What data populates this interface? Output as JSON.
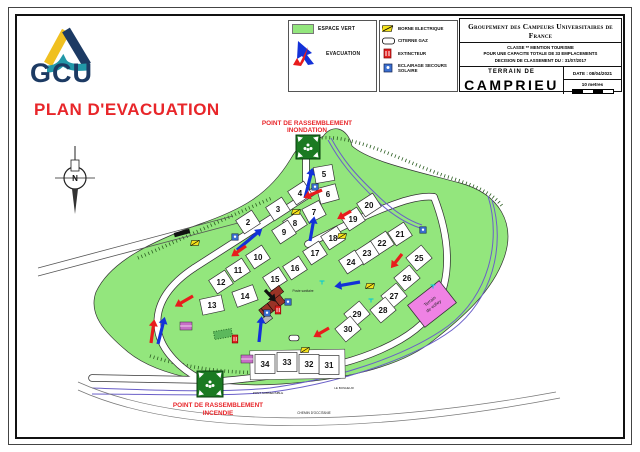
{
  "header": {
    "logo_text": "GCU",
    "legend1": {
      "espace_vert": "ESPACE VERT",
      "evacuation": "EVACUATION"
    },
    "legend2": {
      "borne": "BORNE ELECTRIQUE",
      "citerne": "CITERNE GAZ",
      "extincteur": "EXTINCTEUR",
      "eclairage": "ECLAIRAGE SECOURS SOLAIRE"
    },
    "titleblock": {
      "org": "Groupement des Campeurs Universitaires de France",
      "line1": "CLASSE ** MENTION TOURISME",
      "line2": "POUR UNE CAPACITE TOTALE DE 33 EMPLACEMENTS",
      "line3": "DECISION DE CLASSEMENT DU : 31/07/2017",
      "terrain_de": "TERRAIN DE",
      "site": "CAMPRIEU",
      "date": "DATE : 08/04/2021",
      "scale": "10 metres"
    }
  },
  "title": "PLAN D'EVACUATION",
  "map": {
    "compass_n": "N",
    "colors": {
      "green": "#93e67d",
      "green_edge": "#3a7a2a",
      "red": "#e81c1c",
      "blue": "#1331d8",
      "volley": "#ef82e4",
      "rally_green": "#1b7a22",
      "river": "#6a5fc8"
    },
    "volley": {
      "line1": "Terrain",
      "line2": "de volley",
      "x": 432,
      "y": 304,
      "rot": -38
    },
    "labels": [
      {
        "text": "POINT DE RASSEMBLEMENT",
        "x": 307,
        "y": 125,
        "size": 6.4,
        "color": "#e8262a",
        "bold": true
      },
      {
        "text": "INONDATION",
        "x": 307,
        "y": 132,
        "size": 6.4,
        "color": "#e8262a",
        "bold": true
      },
      {
        "text": "POINT DE RASSEMBLEMENT",
        "x": 218,
        "y": 407,
        "size": 6.4,
        "color": "#e8262a",
        "bold": true
      },
      {
        "text": "INCENDIE",
        "x": 218,
        "y": 415,
        "size": 6.4,
        "color": "#e8262a",
        "bold": true
      },
      {
        "text": "Poste sanitaire",
        "x": 303,
        "y": 292,
        "size": 3.2,
        "color": "#222"
      },
      {
        "text": "PONT SUBMERSIBLE",
        "x": 268,
        "y": 394,
        "size": 3,
        "color": "#222"
      },
      {
        "text": "CHEMIN D'OCCITANIE",
        "x": 314,
        "y": 414,
        "size": 3.2,
        "color": "#222"
      },
      {
        "text": "LE BONHEUR",
        "x": 344,
        "y": 389,
        "size": 3,
        "color": "#222"
      }
    ],
    "plots": [
      {
        "n": "2",
        "x": 248,
        "y": 222,
        "r": -33
      },
      {
        "n": "3",
        "x": 278,
        "y": 209,
        "r": -33
      },
      {
        "n": "4",
        "x": 300,
        "y": 193,
        "r": -33
      },
      {
        "n": "5",
        "x": 324,
        "y": 174,
        "r": -10
      },
      {
        "n": "6",
        "x": 328,
        "y": 194,
        "r": -15
      },
      {
        "n": "7",
        "x": 314,
        "y": 212,
        "r": -28
      },
      {
        "n": "8",
        "x": 295,
        "y": 223,
        "r": -33
      },
      {
        "n": "9",
        "x": 284,
        "y": 232,
        "r": -33
      },
      {
        "n": "10",
        "x": 258,
        "y": 257,
        "r": -33
      },
      {
        "n": "11",
        "x": 238,
        "y": 270,
        "r": -33
      },
      {
        "n": "12",
        "x": 221,
        "y": 282,
        "r": -33
      },
      {
        "n": "13",
        "x": 212,
        "y": 305,
        "r": -12,
        "w": 22
      },
      {
        "n": "14",
        "x": 245,
        "y": 296,
        "r": -20,
        "w": 22
      },
      {
        "n": "15",
        "x": 275,
        "y": 279,
        "r": -33
      },
      {
        "n": "16",
        "x": 295,
        "y": 268,
        "r": -33
      },
      {
        "n": "17",
        "x": 315,
        "y": 253,
        "r": -33
      },
      {
        "n": "18",
        "x": 333,
        "y": 238,
        "r": -33
      },
      {
        "n": "19",
        "x": 353,
        "y": 219,
        "r": -33
      },
      {
        "n": "20",
        "x": 369,
        "y": 205,
        "r": -33
      },
      {
        "n": "21",
        "x": 400,
        "y": 234,
        "r": -33
      },
      {
        "n": "22",
        "x": 382,
        "y": 243,
        "r": -33
      },
      {
        "n": "23",
        "x": 367,
        "y": 253,
        "r": -33
      },
      {
        "n": "24",
        "x": 351,
        "y": 262,
        "r": -33
      },
      {
        "n": "25",
        "x": 419,
        "y": 258,
        "r": -40,
        "w": 20,
        "h": 17
      },
      {
        "n": "26",
        "x": 407,
        "y": 278,
        "r": -40,
        "w": 20,
        "h": 17
      },
      {
        "n": "27",
        "x": 394,
        "y": 296,
        "r": -40,
        "w": 20,
        "h": 17
      },
      {
        "n": "28",
        "x": 383,
        "y": 310,
        "r": -40,
        "w": 20,
        "h": 17
      },
      {
        "n": "29",
        "x": 357,
        "y": 314,
        "r": -40,
        "w": 20,
        "h": 17
      },
      {
        "n": "30",
        "x": 348,
        "y": 329,
        "r": -40,
        "w": 20,
        "h": 17
      },
      {
        "n": "31",
        "x": 329,
        "y": 365,
        "r": 0,
        "w": 20,
        "h": 19
      },
      {
        "n": "32",
        "x": 309,
        "y": 364,
        "r": 0,
        "w": 20,
        "h": 19
      },
      {
        "n": "33",
        "x": 287,
        "y": 362,
        "r": 0,
        "w": 20,
        "h": 19
      },
      {
        "n": "34",
        "x": 265,
        "y": 364,
        "r": 0,
        "w": 20,
        "h": 19
      }
    ],
    "arrows": [
      {
        "x": 305,
        "y": 198,
        "a": 14,
        "l": 31,
        "c": "#1331d8"
      },
      {
        "x": 322,
        "y": 190,
        "a": 247,
        "l": 20,
        "c": "#e81c1c"
      },
      {
        "x": 310,
        "y": 241,
        "a": 10,
        "l": 25,
        "c": "#1331d8"
      },
      {
        "x": 237,
        "y": 250,
        "a": 50,
        "l": 33,
        "c": "#1331d8"
      },
      {
        "x": 246,
        "y": 246,
        "a": 235,
        "l": 18,
        "c": "#e81c1c"
      },
      {
        "x": 193,
        "y": 296,
        "a": 240,
        "l": 21,
        "c": "#e81c1c"
      },
      {
        "x": 158,
        "y": 344,
        "a": 14,
        "l": 28,
        "c": "#1331d8"
      },
      {
        "x": 151,
        "y": 343,
        "a": 8,
        "l": 24,
        "c": "#e81c1c"
      },
      {
        "x": 259,
        "y": 342,
        "a": 6,
        "l": 26,
        "c": "#1331d8"
      },
      {
        "x": 265,
        "y": 290,
        "a": 137,
        "l": 16,
        "c": "#111111"
      },
      {
        "x": 329,
        "y": 328,
        "a": 240,
        "l": 18,
        "c": "#e81c1c"
      },
      {
        "x": 360,
        "y": 282,
        "a": 260,
        "l": 26,
        "c": "#1331d8"
      },
      {
        "x": 402,
        "y": 254,
        "a": 218,
        "l": 18,
        "c": "#e81c1c"
      },
      {
        "x": 351,
        "y": 211,
        "a": 240,
        "l": 16,
        "c": "#e81c1c"
      }
    ],
    "icons": [
      {
        "t": "rally",
        "x": 308,
        "y": 147,
        "s": 24
      },
      {
        "t": "rally",
        "x": 210,
        "y": 384,
        "s": 26
      },
      {
        "t": "borne",
        "x": 195,
        "y": 243
      },
      {
        "t": "borne",
        "x": 296,
        "y": 212
      },
      {
        "t": "borne",
        "x": 342,
        "y": 236
      },
      {
        "t": "borne",
        "x": 370,
        "y": 286
      },
      {
        "t": "borne",
        "x": 305,
        "y": 350
      },
      {
        "t": "citerne",
        "x": 294,
        "y": 338
      },
      {
        "t": "ext",
        "x": 235,
        "y": 339
      },
      {
        "t": "ext",
        "x": 278,
        "y": 310
      },
      {
        "t": "ecl",
        "x": 235,
        "y": 237
      },
      {
        "t": "ecl",
        "x": 315,
        "y": 187
      },
      {
        "t": "ecl",
        "x": 423,
        "y": 230
      },
      {
        "t": "ecl",
        "x": 267,
        "y": 313
      },
      {
        "t": "ecl",
        "x": 288,
        "y": 302
      },
      {
        "t": "tap",
        "x": 322,
        "y": 281
      },
      {
        "t": "tap",
        "x": 371,
        "y": 299
      },
      {
        "t": "tap",
        "x": 433,
        "y": 285
      },
      {
        "t": "bar",
        "x": 182,
        "y": 233,
        "r": -15
      },
      {
        "t": "hut",
        "x": 186,
        "y": 326
      },
      {
        "t": "hut",
        "x": 247,
        "y": 359
      }
    ]
  }
}
